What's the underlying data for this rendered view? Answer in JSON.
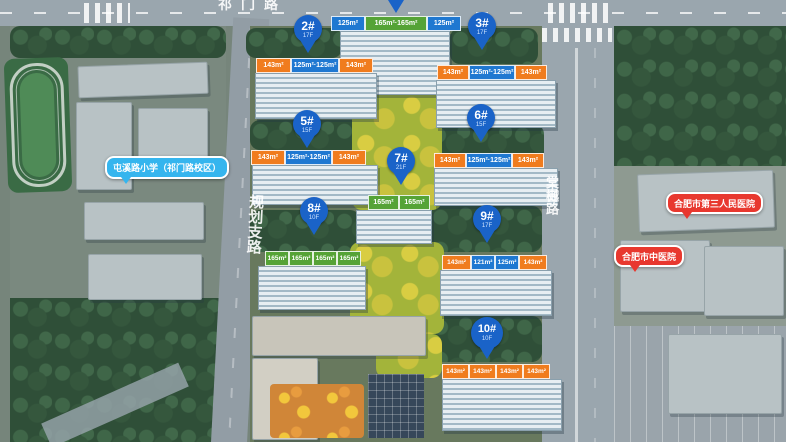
{
  "roads": {
    "top": "祁门路",
    "left": "规划支路",
    "right": "棠樾路"
  },
  "pois": {
    "school": "屯溪路小学（祁门路校区）",
    "hospital_top": "合肥市第三人民医院",
    "hospital_bottom": "合肥市中医院"
  },
  "pins": [
    {
      "num": "2#",
      "floors": "17F"
    },
    {
      "num": "3#",
      "floors": "17F"
    },
    {
      "num": "5#",
      "floors": "15F"
    },
    {
      "num": "6#",
      "floors": "15F"
    },
    {
      "num": "7#",
      "floors": "21F"
    },
    {
      "num": "8#",
      "floors": "10F"
    },
    {
      "num": "9#",
      "floors": "17F"
    },
    {
      "num": "10#",
      "floors": "10F"
    }
  ],
  "unit_rows": [
    {
      "building": "top",
      "tags": [
        {
          "color": "blue",
          "text": "125m²"
        },
        {
          "color": "green",
          "text": "165m²·165m²"
        },
        {
          "color": "blue",
          "text": "125m²"
        }
      ]
    },
    {
      "building": "2#",
      "tags": [
        {
          "color": "orange",
          "text": "143m²"
        },
        {
          "color": "blue",
          "text": "125m²·125m²"
        },
        {
          "color": "orange",
          "text": "143m²"
        }
      ]
    },
    {
      "building": "3#",
      "tags": [
        {
          "color": "orange",
          "text": "143m²"
        },
        {
          "color": "blue",
          "text": "125m²·125m²"
        },
        {
          "color": "orange",
          "text": "143m²"
        }
      ]
    },
    {
      "building": "5#",
      "tags": [
        {
          "color": "orange",
          "text": "143m²"
        },
        {
          "color": "blue",
          "text": "125m²·125m²"
        },
        {
          "color": "orange",
          "text": "143m²"
        }
      ]
    },
    {
      "building": "6#",
      "tags": [
        {
          "color": "orange",
          "text": "143m²"
        },
        {
          "color": "blue",
          "text": "125m²·125m²"
        },
        {
          "color": "orange",
          "text": "143m²"
        }
      ]
    },
    {
      "building": "7#",
      "tags": [
        {
          "color": "green",
          "text": "165m²"
        },
        {
          "color": "green",
          "text": "165m²"
        }
      ]
    },
    {
      "building": "8#",
      "tags": [
        {
          "color": "green",
          "text": "165m²"
        },
        {
          "color": "green",
          "text": "165m²"
        },
        {
          "color": "green",
          "text": "165m²"
        },
        {
          "color": "green",
          "text": "165m²"
        }
      ]
    },
    {
      "building": "9#",
      "tags": [
        {
          "color": "orange",
          "text": "143m²"
        },
        {
          "color": "blue",
          "text": "121m²"
        },
        {
          "color": "blue",
          "text": "125m²"
        },
        {
          "color": "orange",
          "text": "143m²"
        }
      ]
    },
    {
      "building": "10#",
      "tags": [
        {
          "color": "orange",
          "text": "143m²"
        },
        {
          "color": "orange",
          "text": "143m²"
        },
        {
          "color": "orange",
          "text": "143m²"
        },
        {
          "color": "orange",
          "text": "143m²"
        }
      ]
    }
  ],
  "colors": {
    "pin_blue": "#1a63c8",
    "tag_orange": "#f07c1e",
    "tag_blue": "#1f78d1",
    "tag_green": "#55a336",
    "bubble_blue": "#35b5ee",
    "bubble_red": "#e8382f"
  }
}
